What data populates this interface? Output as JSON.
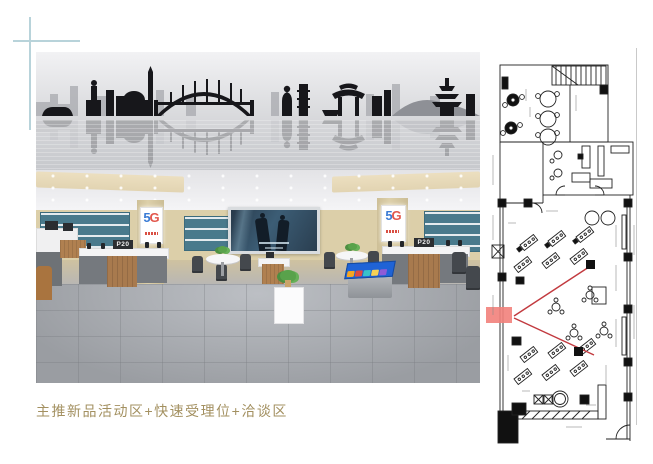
{
  "page": {
    "background": "#ffffff",
    "guide_color": "#b8d3da",
    "edge_line_color": "#c9c9c9"
  },
  "caption": {
    "text": "主推新品活动区+快速受理位+洽谈区",
    "color": "#a39060"
  },
  "render": {
    "description": "3d-store-interior-rendering",
    "posters": {
      "left": {
        "five": "5",
        "g": "G"
      },
      "right": {
        "five": "5",
        "g": "G"
      }
    },
    "signs": {
      "left": "P20",
      "right": "P20"
    },
    "colors": {
      "wall_beige": "#dccfa9",
      "display_teal": "#497a8c",
      "floor_gray": "#9a9da2",
      "wood": "#a87a4e",
      "mural_silhouette": "#1a1a1e",
      "poster_blue": "#3a7bd5",
      "poster_red": "#e2574c",
      "videowall_navy": "#2a3e50"
    }
  },
  "floorplan": {
    "line_color": "#222222",
    "highlight_fill": "#f2817b",
    "sightline_color": "#c23a3f",
    "features": [
      "staircase",
      "round-tables",
      "experience-desks",
      "negotiation-tables",
      "wall-columns",
      "view-cone-highlight",
      "entrance-door",
      "service-room"
    ]
  }
}
